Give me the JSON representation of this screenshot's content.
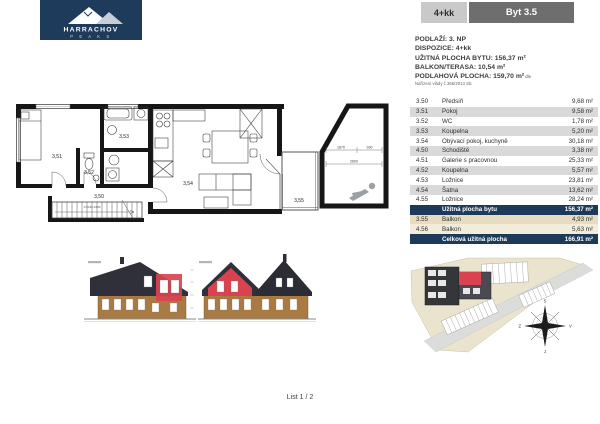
{
  "logo": {
    "brand": "HARRACHOV",
    "sub": "P E A K S"
  },
  "header": {
    "layout_badge": "4+kk",
    "unit_badge": "Byt 3.5"
  },
  "info": {
    "line1": "PODLAŽÍ: 3. NP",
    "line2": "DISPOZICE: 4+kk",
    "line3": "UŽITNÁ PLOCHA BYTU: 156,37 m²",
    "line4": "BALKON/TERASA: 10,54 m²",
    "line5": "PODLAHOVÁ PLOCHA: 159,70 m²",
    "line5_suffix": "dle",
    "note": "Nařízení vlády č.366/2013 Sb."
  },
  "table": {
    "rows": [
      {
        "num": "3.50",
        "name": "Předsíň",
        "area": "9,68 m²"
      },
      {
        "num": "3.51",
        "name": "Pokoj",
        "area": "9,58 m²"
      },
      {
        "num": "3.52",
        "name": "WC",
        "area": "1,78 m²"
      },
      {
        "num": "3.53",
        "name": "Koupelna",
        "area": "5,20 m²"
      },
      {
        "num": "3.54",
        "name": "Obývací pokoj, kuchyně",
        "area": "30,18 m²"
      },
      {
        "num": "4.50",
        "name": "Schodiště",
        "area": "3,38 m²"
      },
      {
        "num": "4.51",
        "name": "Galerie s pracovnou",
        "area": "25,33 m²"
      },
      {
        "num": "4.52",
        "name": "Koupelna",
        "area": "5,57 m²"
      },
      {
        "num": "4.53",
        "name": "Ložnice",
        "area": "23,81 m²"
      },
      {
        "num": "4.54",
        "name": "Šatna",
        "area": "13,62 m²"
      },
      {
        "num": "4.55",
        "name": "Ložnice",
        "area": "28,24 m²"
      }
    ],
    "subtotal": {
      "label": "Užitná plocha bytu",
      "area": "156,37 m²"
    },
    "balcony_rows": [
      {
        "num": "3.55",
        "name": "Balkon",
        "area": "4,93 m²"
      },
      {
        "num": "4.56",
        "name": "Balkon",
        "area": "5,63 m²"
      }
    ],
    "total": {
      "label": "Celková užitná plocha",
      "area": "166,91 m²"
    }
  },
  "plan": {
    "rooms": {
      "r350": "3,50",
      "r351": "3,51",
      "r352": "3,52",
      "r353": "3,53",
      "r354": "3,54",
      "r355": "3,55"
    },
    "stair_note": "17x180,4/250",
    "dims": {
      "d1": "1670",
      "d2": "930",
      "d3": "2600"
    }
  },
  "site": {
    "compass": {
      "n": "S",
      "e": "V",
      "s": "J",
      "w": "Z"
    }
  },
  "footer": {
    "page": "List 1 / 2"
  },
  "colors": {
    "navy": "#1e3b5c",
    "unit_red": "#d94350",
    "stripe": "#d9d9d9",
    "beige": "#e8dcc0",
    "wood": "#a97a42"
  }
}
